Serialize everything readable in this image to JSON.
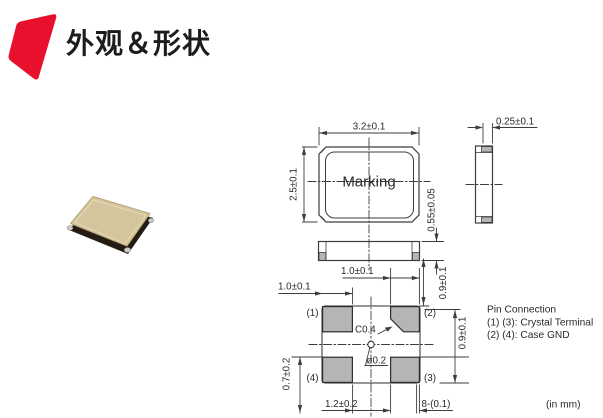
{
  "header": {
    "title": "外观＆形状",
    "accent_color": "#e8102d"
  },
  "photo": {
    "body_color": "#d4c59c",
    "base_color": "#241b12",
    "pad_color": "#c9c9c9"
  },
  "drawing": {
    "line_color": "#3d3d3d",
    "pad_fill": "#b5b5b5",
    "top_view": {
      "marking_label": "Marking",
      "width_dim": "3.2±0.1",
      "height_dim": "2.5±0.1"
    },
    "side_view": {
      "pad_dim": "0.25±0.1"
    },
    "front_view": {
      "thickness_dim": "0.55±0.05"
    },
    "land_pattern": {
      "pad1_label": "(1)",
      "pad2_label": "(2)",
      "pad3_label": "(3)",
      "pad4_label": "(4)",
      "dim_pad_width_left": "1.0±0.1",
      "dim_pad_width_mid": "1.0±0.1",
      "dim_right_top": "0.9±0.1",
      "dim_right_mid": "0.9±0.1",
      "dim_left_bottom": "0.7±0.2",
      "dim_gap_bottom": "1.2±0.2",
      "dim_corner_radius": "8-(0.1)",
      "chamfer_note": "C0.4",
      "hole_note": "ø0.2"
    },
    "pin_connection": {
      "title": "Pin Connection",
      "line1": "(1) (3): Crystal Terminal",
      "line2": "(2) (4): Case GND"
    },
    "units_note": "(in mm)"
  }
}
